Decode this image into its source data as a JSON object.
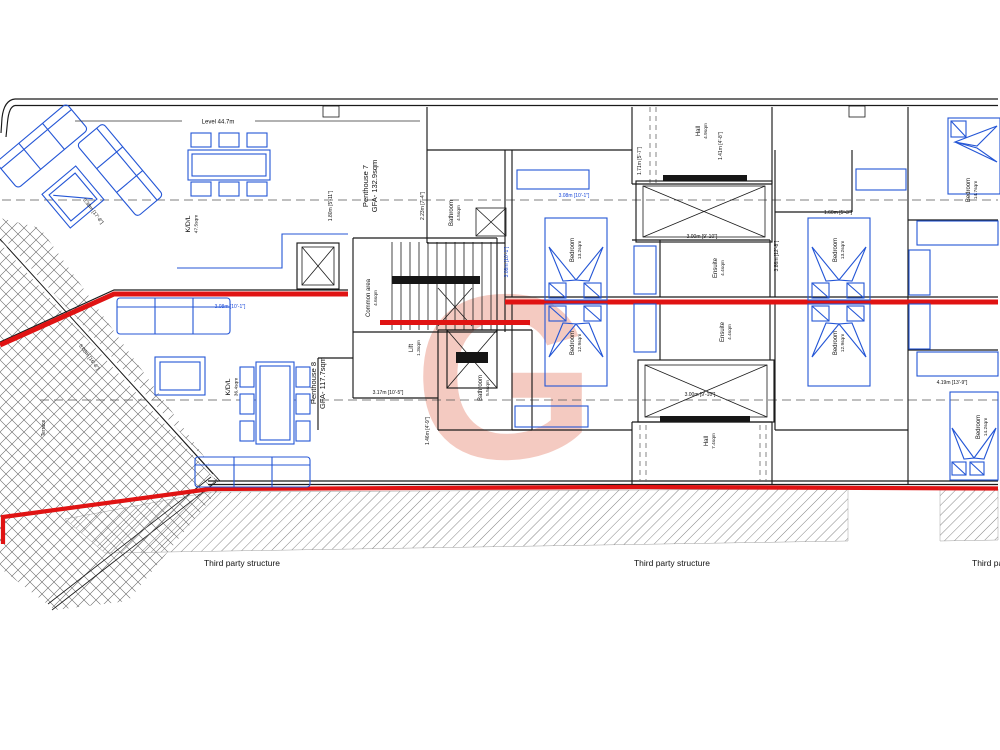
{
  "plan": {
    "level_label": "Level 44.7m",
    "watermark_letter": "G",
    "third_party": {
      "label1": "Third party structure",
      "label2": "Third party structure",
      "label3": "Third party structure"
    },
    "units": {
      "penthouse7": {
        "name": "Penthouse 7",
        "gfa": "GFA- 132.9sqm"
      },
      "penthouse8": {
        "name": "Penthouse 8",
        "gfa": "GFA- 117.7sqm"
      }
    },
    "rooms": {
      "kdl7": {
        "name": "K/D/L",
        "area": "47.5sqm"
      },
      "kdl8": {
        "name": "K/D/L",
        "area": "36.4sqm"
      },
      "common_area": {
        "name": "Common area",
        "area": "4.6sqm"
      },
      "lift": {
        "name": "Lift",
        "area": "1.3sqm"
      },
      "bathroom7": {
        "name": "Bathroom",
        "area": "4.5sqm"
      },
      "bathroom8": {
        "name": "Bathroom",
        "area": "5.5sqm"
      },
      "hall_top": {
        "name": "Hall",
        "area": "4.9sqm"
      },
      "hall_bottom": {
        "name": "Hall",
        "area": "7.4sqm"
      },
      "ensuite_top": {
        "name": "Ensuite",
        "area": "4.4sqm"
      },
      "ensuite_bottom": {
        "name": "Ensuite",
        "area": "4.4sqm"
      },
      "bedroom_mid_top": {
        "name": "Bedroom",
        "area": "13.2sqm"
      },
      "bedroom_mid_bottom": {
        "name": "Bedroom",
        "area": "12.9sqm"
      },
      "bedroom_right_top": {
        "name": "Bedroom",
        "area": "13.2sqm"
      },
      "bedroom_right_bottom": {
        "name": "Bedroom",
        "area": "12.9sqm"
      },
      "bedroom_far_top": {
        "name": "Bedroom",
        "area": "14.7sqm"
      },
      "bedroom_far_bottom": {
        "name": "Bedroom",
        "area": "14.2sqm"
      },
      "terrace": {
        "name": "Terrace"
      }
    },
    "dims": {
      "d1": "3.08m [10'-1\"]",
      "d2": "3.08m [10'-1\"]",
      "d3": "3.00m [9'-10\"]",
      "d4": "3.00m [9'-10\"]",
      "d5": "3.17m [10'-5\"]",
      "d6": "4.19m [13'-9\"]",
      "d7": "5.08m [16'-8\"]",
      "d8": "1.80m [5'-11\"]",
      "d9": "1.46m [4'-9\"]",
      "d10": "1.71m [5'-7\"]",
      "d11": "3.86m [12'-8\"]",
      "d12": "3.08m [10'-1\"]",
      "d13": "5.38m [17'-8\"]",
      "d14": "1.60m [5'-3\"]",
      "d15": "2.23m [7'-4\"]",
      "d16": "1.41m [4'-8\"]"
    },
    "colors": {
      "party_wall_red": "#e01313",
      "furniture_blue": "#2456d6",
      "dimension_blue": "#1a49d9",
      "watermark_salmon": "#f0c3b7",
      "wall_black": "#1a1a1a"
    }
  }
}
